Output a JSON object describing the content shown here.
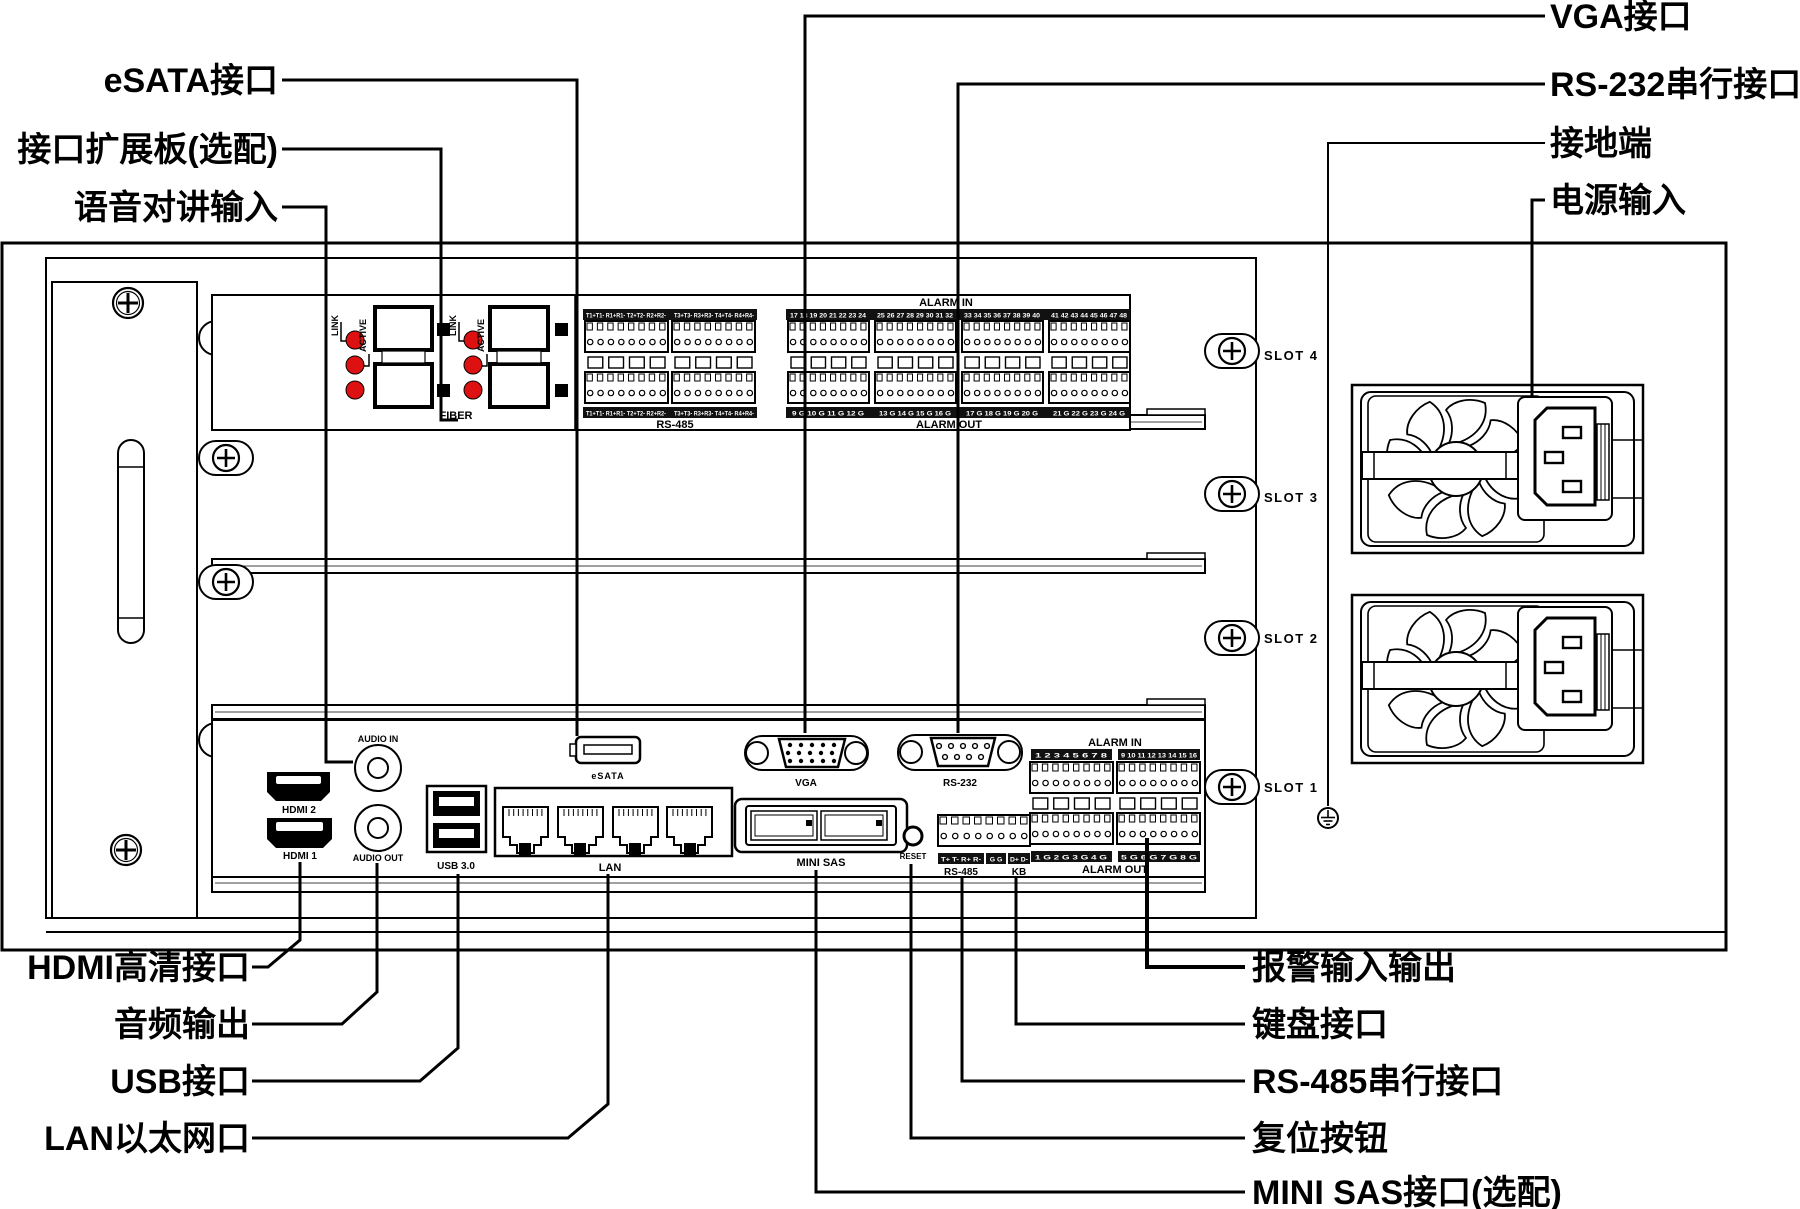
{
  "callouts": {
    "esata": "eSATA接口",
    "expansion": "接口扩展板(选配)",
    "audio_talk": "语音对讲输入",
    "vga": "VGA接口",
    "rs232": "RS-232串行接口",
    "ground": "接地端",
    "power": "电源输入",
    "hdmi": "HDMI高清接口",
    "audio_out": "音频输出",
    "usb": "USB接口",
    "lan": "LAN以太网口",
    "alarm": "报警输入输出",
    "keyboard": "键盘接口",
    "rs485": "RS-485串行接口",
    "reset": "复位按钮",
    "minisas": "MINI SAS接口(选配)"
  },
  "slots": {
    "s4": "SLOT 4",
    "s3": "SLOT 3",
    "s2": "SLOT 2",
    "s1": "SLOT 1"
  },
  "expansion_board": {
    "fiber": {
      "label": "FIBER",
      "link": "LINK",
      "active": "ACTIVE",
      "badge_2": "2",
      "badge_1": "1",
      "badge_4": "4",
      "badge_3": "3"
    },
    "rs485": {
      "label": "RS-485",
      "strip_left": "T1+T1- R1+R1- T2+T2- R2+R2-",
      "strip_right": "T3+T3- R3+R3- T4+T4- R4+R4-"
    },
    "alarm": {
      "in_label": "ALARM IN",
      "out_label": "ALARM OUT",
      "in_strips": [
        "17 18 19 20 21 22 23 24",
        "25 26 27 28 29 30 31 32",
        "33 34 35 36 37 38 39 40",
        "41 42 43 44 45 46 47 48"
      ],
      "out_strips": [
        "9 G 10 G 11 G 12 G",
        "13 G 14 G 15 G 16 G",
        "17 G 18 G 19 G 20 G",
        "21 G 22 G 23 G 24 G"
      ]
    }
  },
  "main_board": {
    "audio_in": "AUDIO IN",
    "audio_out": "AUDIO OUT",
    "hdmi2": "HDMI 2",
    "hdmi1": "HDMI 1",
    "usb": "USB 3.0",
    "lan": "LAN",
    "lan_ports": [
      "1",
      "2",
      "3",
      "4"
    ],
    "esata": "eSATA",
    "vga": "VGA",
    "rs232": "RS-232",
    "minisas": "MINI SAS",
    "reset": "RESET",
    "rs485_kb": {
      "rs485": "RS-485",
      "kb": "KB",
      "strip_rs485": "T+ T- R+ R-",
      "strip_g": "G G",
      "strip_kb": "D+ D-"
    },
    "alarm": {
      "in_label": "ALARM IN",
      "out_label": "ALARM OUT",
      "in_strips": [
        "1 2 3 4 5 6 7 8",
        "9 10 11 12 13 14 15 16"
      ],
      "out_strips": [
        "1 G 2 G 3 G 4 G",
        "5 G 6 G 7 G 8 G"
      ]
    }
  },
  "colors": {
    "led_red": "#dd1111",
    "line": "#000000",
    "background": "#ffffff",
    "strip_bg": "#111111"
  }
}
